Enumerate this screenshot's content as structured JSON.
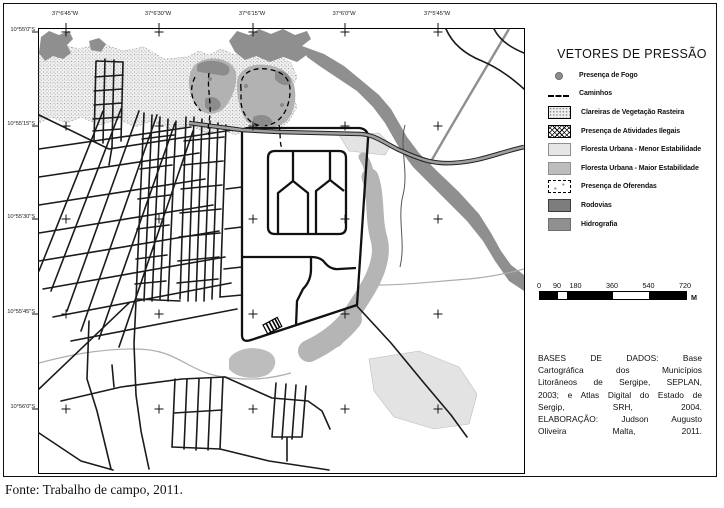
{
  "map": {
    "top_axis_labels": [
      "37°6'45\"W",
      "37°6'30\"W",
      "37°6'15\"W",
      "37°6'0\"W",
      "37°5'45\"W"
    ],
    "left_axis_labels": [
      "10°55'0\"S",
      "10°55'15\"S",
      "10°55'30\"S",
      "10°55'45\"S",
      "10°56'0\"S"
    ]
  },
  "legend": {
    "title": "VETORES DE PRESSÃO",
    "items": [
      {
        "symbol": "fire-dot",
        "label": "Presença de Fogo"
      },
      {
        "symbol": "dashed-line",
        "label": "Caminhos"
      },
      {
        "symbol": "stipple-box",
        "label": "Clareiras de Vegetação Rasteira"
      },
      {
        "symbol": "crosshatch-box",
        "label": "Presença de Atividades Ilegais"
      },
      {
        "symbol": "light-gray-box",
        "label": "Floresta Urbana - Menor Estabilidade"
      },
      {
        "symbol": "medium-gray-box",
        "label": "Floresta Urbana - Maior Estabilidade"
      },
      {
        "symbol": "dashed-outline-box",
        "label": "Presença de Oferendas"
      },
      {
        "symbol": "dark-gray-box",
        "label": "Rodovias"
      },
      {
        "symbol": "gray-box",
        "label": "Hidrografia"
      }
    ]
  },
  "scalebar": {
    "tick_labels": [
      "0",
      "90",
      "180",
      "360",
      "540",
      "720"
    ],
    "unit": "M"
  },
  "credits": {
    "lines": [
      "BASES DE DADOS: Base",
      "Cartográfica dos Municípios",
      "Litorâneos de Sergipe, SEPLAN,",
      "2003; e Atlas Digital do Estado de",
      "Sergip, SRH, 2004.",
      "ELABORAÇÃO: Judson Augusto",
      "Oliveira Malta, 2011."
    ]
  },
  "source_note": "Fonte: Trabalho de campo, 2011.",
  "colors": {
    "hydrography": "#8f8f8f",
    "highway_fill": "#9f9f9f",
    "forest_major_stability": "#b5b5b5",
    "forest_minor_stability": "#e3e3e3",
    "streets": "#1b1b1b"
  }
}
